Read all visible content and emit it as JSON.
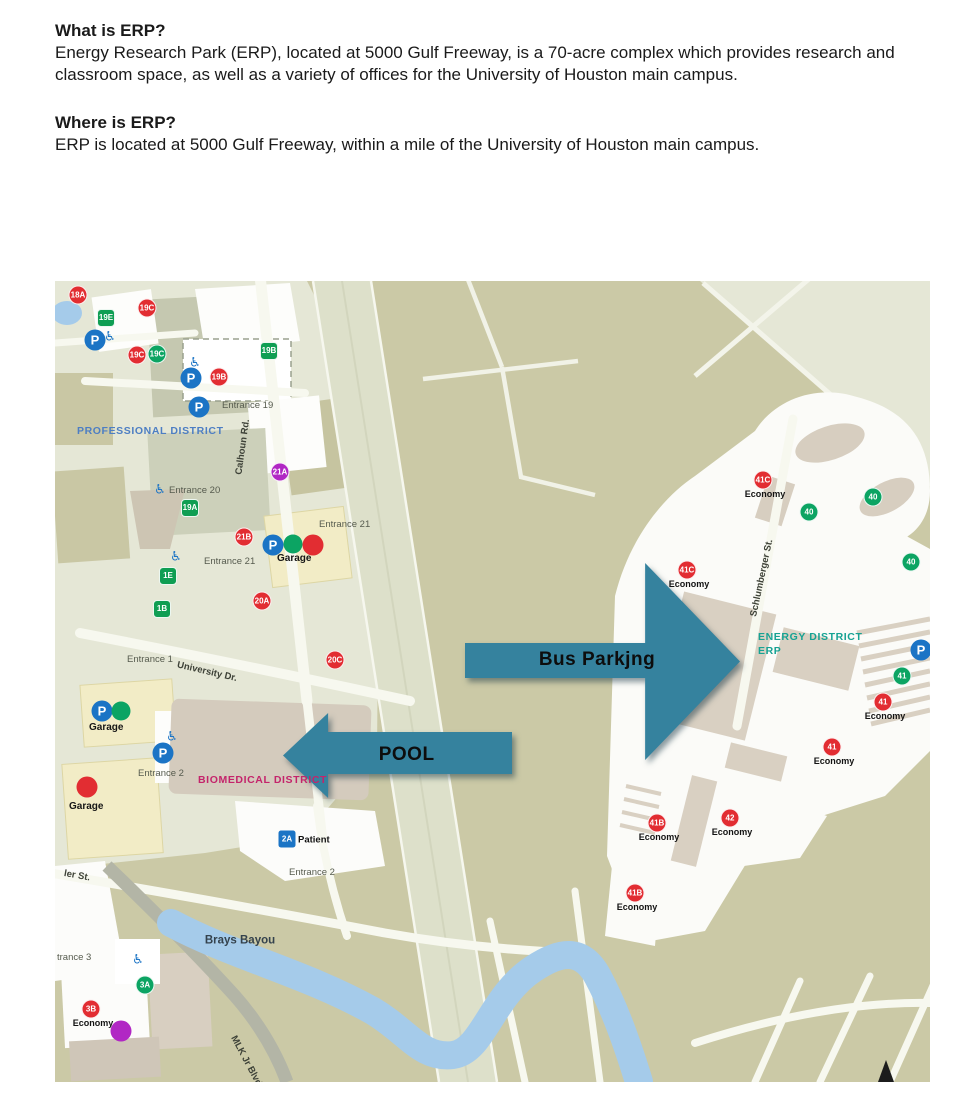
{
  "article": {
    "sections": [
      {
        "heading": "What is ERP?",
        "body": "Energy Research Park (ERP), located at 5000 Gulf Freeway, is a 70-acre complex which provides research and classroom space, as well as a variety of offices for the University of Houston main campus."
      },
      {
        "heading": "Where is ERP?",
        "body": "ERP is located at 5000 Gulf Freeway, within a mile of the University of Houston main campus."
      }
    ]
  },
  "colors": {
    "map_bg": "#e5e7d6",
    "field_olive": "#cbc9a6",
    "water": "#a5cbea",
    "arrow_teal": "#35829e",
    "arrow_label": "#0d0d0d",
    "marker_red": "#e22d32",
    "marker_green": "#0ca463",
    "marker_green_square": "#0f9e53",
    "marker_purple": "#b127c4",
    "parking_blue": "#1b74c5",
    "accessible_blue": "#1b74c5",
    "district_blue": "#4d7ec3",
    "district_magenta": "#c4246b",
    "district_teal": "#16a293"
  },
  "map": {
    "arrows": [
      {
        "label": "Bus Parkjng",
        "direction": "right",
        "x": 410,
        "y": 282,
        "w": 275,
        "h": 197,
        "tail_top_pct": 40.6,
        "tail_bottom_pct": 58.4,
        "head_pct": 65.5,
        "label_left_pct": 48,
        "label_top_pct": 49
      },
      {
        "label": "POOL",
        "direction": "left",
        "x": 228,
        "y": 432,
        "w": 229,
        "h": 85,
        "tail_top_pct": 22.4,
        "tail_bottom_pct": 71.8,
        "head_pct": 19.7,
        "label_left_pct": 54,
        "label_top_pct": 49
      }
    ],
    "labels": [
      {
        "text": "PROFESSIONAL DISTRICT",
        "cls": "district",
        "x": 22,
        "y": 145,
        "color": "#4d7ec3"
      },
      {
        "text": "BIOMEDICAL DISTRICT",
        "cls": "district",
        "x": 143,
        "y": 494,
        "color": "#c4246b"
      },
      {
        "text": "ENERGY DISTRICT",
        "cls": "district",
        "x": 703,
        "y": 351,
        "color": "#16a293"
      },
      {
        "text": "ERP",
        "cls": "district",
        "x": 703,
        "y": 365,
        "color": "#16a293"
      },
      {
        "text": "Calhoun Rd.",
        "cls": "street",
        "x": 188,
        "y": 166,
        "rot": -82
      },
      {
        "text": "University Dr.",
        "cls": "street",
        "x": 152,
        "y": 391,
        "rot": 13
      },
      {
        "text": "Schlumberger St.",
        "cls": "street",
        "x": 707,
        "y": 297,
        "rot": -78
      },
      {
        "text": "MLK Jr Blvd",
        "cls": "street",
        "x": 191,
        "y": 780,
        "rot": 62
      },
      {
        "text": "ler St.",
        "cls": "street",
        "x": 22,
        "y": 595,
        "rot": 10
      },
      {
        "text": "Brays Bayou",
        "cls": "bayou",
        "x": 185,
        "y": 660,
        "rot": 0
      },
      {
        "text": "Entrance 19",
        "cls": "entrance",
        "x": 167,
        "y": 120
      },
      {
        "text": "Entrance 20",
        "cls": "entrance",
        "x": 114,
        "y": 205
      },
      {
        "text": "Entrance 21",
        "cls": "entrance",
        "x": 264,
        "y": 239
      },
      {
        "text": "Entrance 21",
        "cls": "entrance",
        "x": 149,
        "y": 276
      },
      {
        "text": "Entrance 1",
        "cls": "entrance",
        "x": 72,
        "y": 374
      },
      {
        "text": "Entrance 2",
        "cls": "entrance",
        "x": 83,
        "y": 488
      },
      {
        "text": "Entrance 2",
        "cls": "entrance",
        "x": 234,
        "y": 587
      },
      {
        "text": "trance 3",
        "cls": "entrance",
        "x": 2,
        "y": 672
      },
      {
        "text": "Garage",
        "cls": "garage",
        "x": 222,
        "y": 273
      },
      {
        "text": "Garage",
        "cls": "garage",
        "x": 34,
        "y": 442
      },
      {
        "text": "Garage",
        "cls": "garage",
        "x": 14,
        "y": 521
      }
    ],
    "markers": [
      {
        "t": "18A",
        "kind": "red",
        "x": 23,
        "y": 14
      },
      {
        "t": "19C",
        "kind": "red",
        "x": 92,
        "y": 27
      },
      {
        "t": "19C",
        "kind": "red",
        "x": 82,
        "y": 74
      },
      {
        "t": "19B",
        "kind": "red",
        "x": 164,
        "y": 96
      },
      {
        "t": "21B",
        "kind": "red",
        "x": 189,
        "y": 256
      },
      {
        "t": "20A",
        "kind": "red",
        "x": 207,
        "y": 320
      },
      {
        "t": "20C",
        "kind": "red",
        "x": 280,
        "y": 379
      },
      {
        "t": "41C",
        "kind": "red",
        "x": 708,
        "y": 199,
        "sub": "Economy"
      },
      {
        "t": "41C",
        "kind": "red",
        "x": 632,
        "y": 289,
        "sub": "Economy"
      },
      {
        "t": "41",
        "kind": "red",
        "x": 828,
        "y": 421,
        "sub": "Economy"
      },
      {
        "t": "41",
        "kind": "red",
        "x": 777,
        "y": 466,
        "sub": "Economy"
      },
      {
        "t": "42",
        "kind": "red",
        "x": 675,
        "y": 537,
        "sub": "Economy"
      },
      {
        "t": "41B",
        "kind": "red",
        "x": 602,
        "y": 542,
        "sub": "Economy"
      },
      {
        "t": "41B",
        "kind": "red",
        "x": 580,
        "y": 612,
        "sub": "Economy"
      },
      {
        "t": "3B",
        "kind": "red",
        "x": 36,
        "y": 728,
        "sub": "Economy"
      },
      {
        "t": "19C",
        "kind": "green",
        "x": 102,
        "y": 73
      },
      {
        "t": "40",
        "kind": "green",
        "x": 818,
        "y": 216
      },
      {
        "t": "40",
        "kind": "green",
        "x": 754,
        "y": 231
      },
      {
        "t": "40",
        "kind": "green",
        "x": 856,
        "y": 281
      },
      {
        "t": "41",
        "kind": "green",
        "x": 847,
        "y": 395
      },
      {
        "t": "3A",
        "kind": "green",
        "x": 90,
        "y": 704
      },
      {
        "t": "19E",
        "kind": "greensq",
        "x": 51,
        "y": 37
      },
      {
        "t": "19B",
        "kind": "greensq",
        "x": 214,
        "y": 70
      },
      {
        "t": "19A",
        "kind": "greensq",
        "x": 135,
        "y": 227
      },
      {
        "t": "1E",
        "kind": "greensq",
        "x": 113,
        "y": 295
      },
      {
        "t": "1B",
        "kind": "greensq",
        "x": 107,
        "y": 328
      },
      {
        "t": "21A",
        "kind": "purple",
        "x": 225,
        "y": 191
      },
      {
        "t": "2A",
        "kind": "bluesq",
        "x": 232,
        "y": 558,
        "subr": "Patient"
      },
      {
        "t": "P",
        "kind": "P",
        "x": 40,
        "y": 59
      },
      {
        "t": "P",
        "kind": "P",
        "x": 136,
        "y": 97
      },
      {
        "t": "P",
        "kind": "P",
        "x": 144,
        "y": 126
      },
      {
        "t": "P",
        "kind": "P",
        "x": 218,
        "y": 264
      },
      {
        "t": "P",
        "kind": "P",
        "x": 47,
        "y": 430
      },
      {
        "t": "P",
        "kind": "P",
        "x": 108,
        "y": 472
      },
      {
        "t": "P",
        "kind": "P",
        "x": 866,
        "y": 369
      },
      {
        "t": "♿",
        "kind": "acc",
        "x": 55,
        "y": 56
      },
      {
        "t": "♿",
        "kind": "acc",
        "x": 140,
        "y": 82
      },
      {
        "t": "♿",
        "kind": "acc",
        "x": 105,
        "y": 209
      },
      {
        "t": "♿",
        "kind": "acc",
        "x": 121,
        "y": 276
      },
      {
        "t": "♿",
        "kind": "acc",
        "x": 117,
        "y": 456
      },
      {
        "t": "♿",
        "kind": "acc",
        "x": 83,
        "y": 679
      },
      {
        "kind": "dotg",
        "x": 238,
        "y": 263
      },
      {
        "kind": "dotr",
        "x": 258,
        "y": 264
      },
      {
        "kind": "dotg",
        "x": 66,
        "y": 430
      },
      {
        "kind": "dotr",
        "x": 32,
        "y": 506
      },
      {
        "kind": "dotp",
        "x": 66,
        "y": 750
      }
    ]
  }
}
